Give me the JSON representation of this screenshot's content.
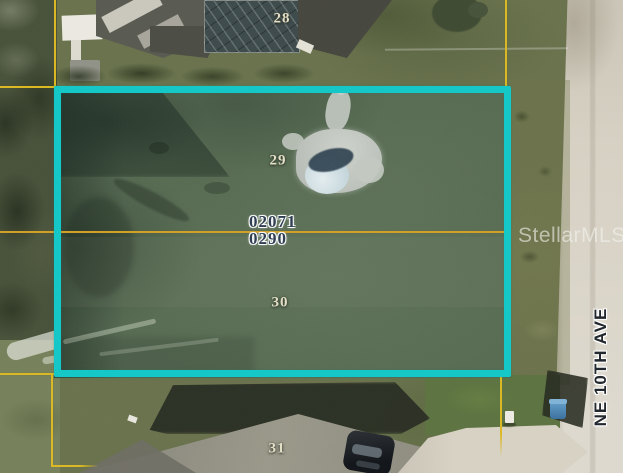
{
  "overlay": {
    "parcel_id": {
      "line1": "02071",
      "line2": "0290"
    },
    "lot_numbers": [
      {
        "label": "28"
      },
      {
        "label": "29"
      },
      {
        "label": "30"
      },
      {
        "label": "31"
      }
    ],
    "street_label": "NE 10TH AVE",
    "watermark_text": "StellarMLS",
    "colors": {
      "lot_highlight": "#14c6c7",
      "parcel_boundary_line": "#d9b822",
      "parcel_id_text": "#2d3c50",
      "lot_number_text": "#e3dec6",
      "street_text": "#20262b",
      "road_surface": "#d6d0c3",
      "grass": "#68714c"
    }
  }
}
